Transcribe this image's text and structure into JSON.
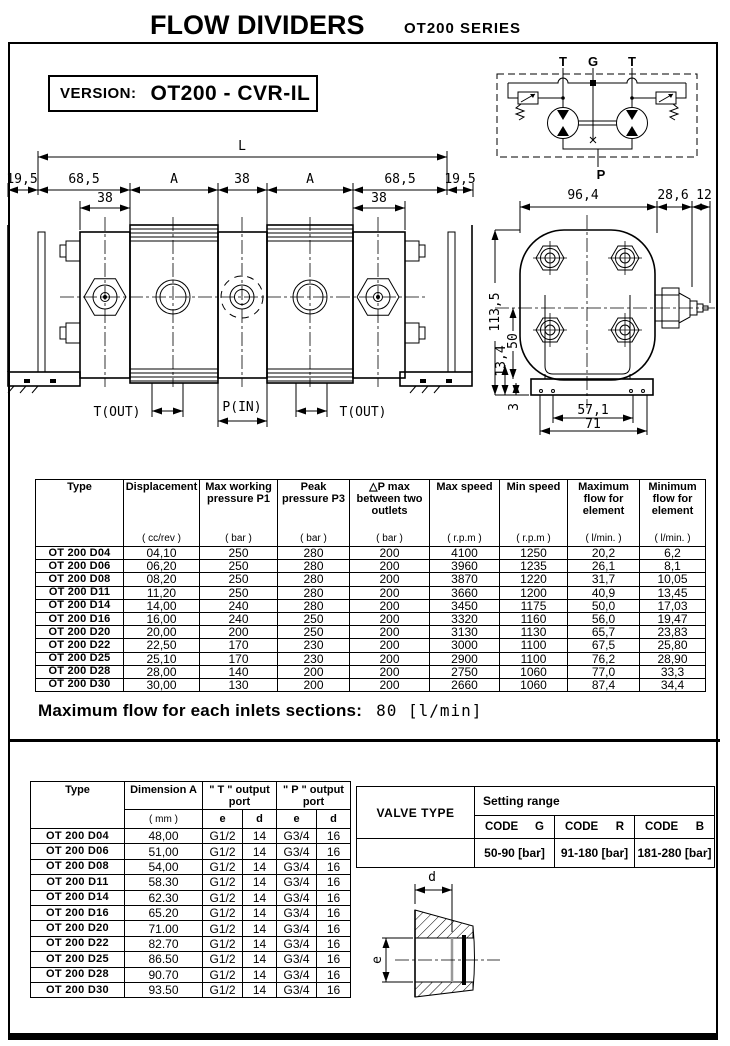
{
  "header": {
    "title": "FLOW DIVIDERS",
    "series": "OT200  SERIES"
  },
  "version": {
    "label": "VERSION:",
    "value": "OT200 - CVR-IL"
  },
  "schematic": {
    "t_left": "T",
    "g": "G",
    "t_right": "T",
    "p": "P"
  },
  "front_view": {
    "dim_L": "L",
    "dim_19_5_left": "19,5",
    "dim_68_5_left": "68,5",
    "dim_A_left": "A",
    "dim_38_center": "38",
    "dim_A_right": "A",
    "dim_68_5_right": "68,5",
    "dim_19_5_right": "19,5",
    "dim_38_left": "38",
    "dim_38_right": "38",
    "port_left": "T(OUT)",
    "port_center": "P(IN)",
    "port_right": "T(OUT)"
  },
  "side_view": {
    "dim_width": "96,4",
    "dim_valve": "28,6",
    "dim_tip": "12",
    "dim_height": "113,5",
    "dim_50": "50",
    "dim_13_4": "13,4",
    "dim_3": "3",
    "dim_57_1": "57,1",
    "dim_71": "71"
  },
  "spec_table": {
    "columns": [
      {
        "title": "Type",
        "sub": ""
      },
      {
        "title": "Displacement",
        "sub": "( cc/rev )"
      },
      {
        "title": "Max working pressure P1",
        "sub": "( bar )"
      },
      {
        "title": "Peak pressure P3",
        "sub": "( bar )"
      },
      {
        "title": "△P max between two outlets",
        "sub": "( bar )"
      },
      {
        "title": "Max speed",
        "sub": "( r.p.m )"
      },
      {
        "title": "Min speed",
        "sub": "( r.p.m )"
      },
      {
        "title": "Maximum flow for element",
        "sub": "( l/min. )"
      },
      {
        "title": "Minimum flow for element",
        "sub": "( l/min. )"
      }
    ],
    "rows": [
      [
        "OT 200 D04",
        "04,10",
        "250",
        "280",
        "200",
        "4100",
        "1250",
        "20,2",
        "6,2"
      ],
      [
        "OT 200 D06",
        "06,20",
        "250",
        "280",
        "200",
        "3960",
        "1235",
        "26,1",
        "8,1"
      ],
      [
        "OT 200 D08",
        "08,20",
        "250",
        "280",
        "200",
        "3870",
        "1220",
        "31,7",
        "10,05"
      ],
      [
        "OT 200 D11",
        "11,20",
        "250",
        "280",
        "200",
        "3660",
        "1200",
        "40,9",
        "13,45"
      ],
      [
        "OT 200 D14",
        "14,00",
        "240",
        "280",
        "200",
        "3450",
        "1175",
        "50,0",
        "17,03"
      ],
      [
        "OT 200 D16",
        "16,00",
        "240",
        "250",
        "200",
        "3320",
        "1160",
        "56,0",
        "19,47"
      ],
      [
        "OT 200 D20",
        "20,00",
        "200",
        "250",
        "200",
        "3130",
        "1130",
        "65,7",
        "23,83"
      ],
      [
        "OT 200 D22",
        "22,50",
        "170",
        "230",
        "200",
        "3000",
        "1100",
        "67,5",
        "25,80"
      ],
      [
        "OT 200 D25",
        "25,10",
        "170",
        "230",
        "200",
        "2900",
        "1100",
        "76,2",
        "28,90"
      ],
      [
        "OT 200 D28",
        "28,00",
        "140",
        "200",
        "200",
        "2750",
        "1060",
        "77,0",
        "33,3"
      ],
      [
        "OT 200 D30",
        "30,00",
        "130",
        "200",
        "200",
        "2660",
        "1060",
        "87,4",
        "34,4"
      ]
    ]
  },
  "max_flow_note": {
    "label": "Maximum flow for each inlets sections:",
    "value": "80 [l/min]"
  },
  "dim_table": {
    "col_type": "Type",
    "col_dim": "Dimension A",
    "col_dim_sub": "( mm )",
    "col_t": "\" T \" output port",
    "col_p": "\" P \" output port",
    "sub_e": "e",
    "sub_d": "d",
    "rows": [
      [
        "OT 200 D04",
        "48,00",
        "G1/2",
        "14",
        "G3/4",
        "16"
      ],
      [
        "OT 200 D06",
        "51,00",
        "G1/2",
        "14",
        "G3/4",
        "16"
      ],
      [
        "OT 200 D08",
        "54,00",
        "G1/2",
        "14",
        "G3/4",
        "16"
      ],
      [
        "OT 200 D11",
        "58.30",
        "G1/2",
        "14",
        "G3/4",
        "16"
      ],
      [
        "OT 200 D14",
        "62.30",
        "G1/2",
        "14",
        "G3/4",
        "16"
      ],
      [
        "OT 200 D16",
        "65.20",
        "G1/2",
        "14",
        "G3/4",
        "16"
      ],
      [
        "OT 200 D20",
        "71.00",
        "G1/2",
        "14",
        "G3/4",
        "16"
      ],
      [
        "OT 200 D22",
        "82.70",
        "G1/2",
        "14",
        "G3/4",
        "16"
      ],
      [
        "OT 200 D25",
        "86.50",
        "G1/2",
        "14",
        "G3/4",
        "16"
      ],
      [
        "OT 200 D28",
        "90.70",
        "G1/2",
        "14",
        "G3/4",
        "16"
      ],
      [
        "OT 200 D30",
        "93.50",
        "G1/2",
        "14",
        "G3/4",
        "16"
      ]
    ]
  },
  "valve_table": {
    "title": "VALVE TYPE",
    "setting_range_label": "Setting range",
    "codes": [
      {
        "label": "CODE",
        "letter": "G"
      },
      {
        "label": "CODE",
        "letter": "R"
      },
      {
        "label": "CODE",
        "letter": "B"
      }
    ],
    "ranges": [
      "50-90 [bar]",
      "91-180 [bar]",
      "181-280 [bar]"
    ]
  },
  "port_drawing": {
    "dim_d": "d",
    "dim_e": "e"
  }
}
